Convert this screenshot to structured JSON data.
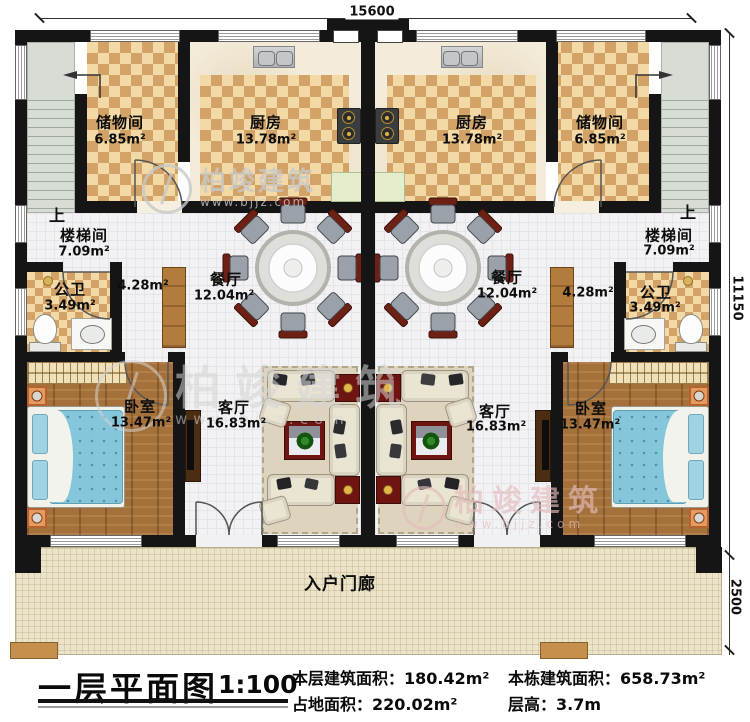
{
  "title_block": {
    "title": "一层平面图",
    "scale": "1:100",
    "stats": [
      {
        "label": "本层建筑面积：",
        "value": "180.42m²"
      },
      {
        "label": "占地面积：",
        "value": "220.02m²"
      },
      {
        "label": "本栋建筑面积：",
        "value": "658.73m²"
      },
      {
        "label": "层高：",
        "value": "3.7m"
      }
    ]
  },
  "dimensions": {
    "top_width": "15600",
    "right_height": "11150",
    "porch_depth": "2500"
  },
  "rooms": {
    "storage": {
      "label": "储物间",
      "area": "6.85m²"
    },
    "kitchen": {
      "label": "厨房",
      "area": "13.78m²"
    },
    "stair_hall": {
      "label": "楼梯间",
      "area": "7.09m²"
    },
    "bathroom": {
      "label": "公卫",
      "area": "3.49m²"
    },
    "corridor": {
      "area": "4.28m²"
    },
    "dining": {
      "label": "餐厅",
      "area": "12.04m²"
    },
    "living": {
      "label": "客厅",
      "area": "16.83m²"
    },
    "bedroom": {
      "label": "卧室",
      "area": "13.47m²"
    },
    "porch": {
      "label": "入户门廊"
    }
  },
  "annotations": {
    "stairs_up": "上"
  },
  "watermark": {
    "brand": "柏竣建筑",
    "url": "www.bjjz.com"
  }
}
